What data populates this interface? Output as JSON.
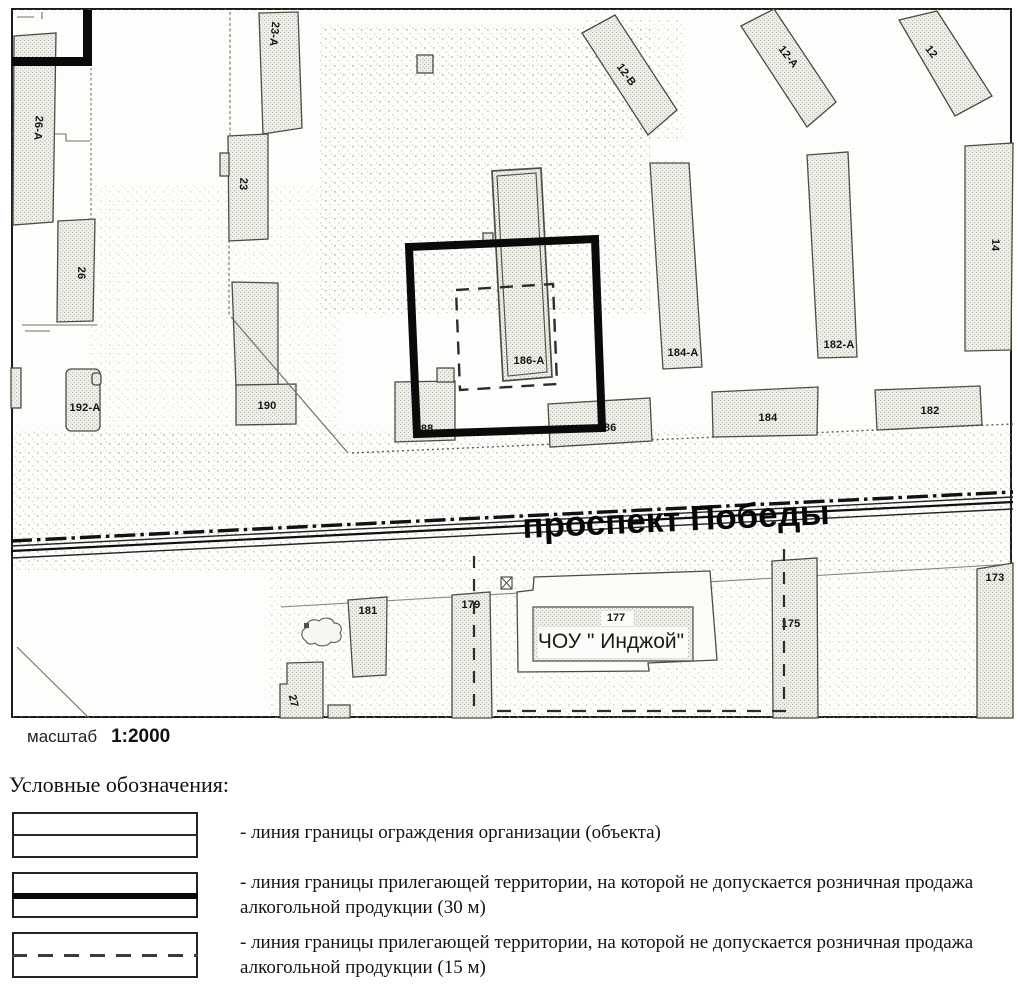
{
  "map": {
    "street": "проспект Победы",
    "scale_label": "масштаб",
    "scale_value": "1:2000",
    "buildings": [
      {
        "label": "26-А"
      },
      {
        "label": "26"
      },
      {
        "label": "23-А"
      },
      {
        "label": "23"
      },
      {
        "label": "192-А"
      },
      {
        "label": "190"
      },
      {
        "label": "188"
      },
      {
        "label": "186"
      },
      {
        "label": "186-А"
      },
      {
        "label": "184-А"
      },
      {
        "label": "182-А"
      },
      {
        "label": "184"
      },
      {
        "label": "182"
      },
      {
        "label": "12-В"
      },
      {
        "label": "12-А"
      },
      {
        "label": "12"
      },
      {
        "label": "14"
      },
      {
        "label": "181"
      },
      {
        "label": "179"
      },
      {
        "label": "177"
      },
      {
        "label": "ЧОУ \" Инджой\""
      },
      {
        "label": "175"
      },
      {
        "label": "173"
      },
      {
        "label": "27"
      }
    ],
    "icons": {
      "crossed_square": "utility-marker",
      "vegetation_blob": "tree-canopy"
    }
  },
  "legend": {
    "heading": "Условные обозначения:",
    "items": [
      {
        "text": "- линия границы ограждения организации (объекта)",
        "line_style": "solid-thin"
      },
      {
        "text": "- линия границы прилегающей территории, на которой не допускается розничная продажа алкогольной продукции (30 м)",
        "line_style": "solid-thick"
      },
      {
        "text": "- линия границы прилегающей территории, на которой не допускается розничная продажа алкогольной продукции (15 м)",
        "line_style": "dashed"
      }
    ]
  },
  "colors": {
    "boundary_30m": "#0a0a0a",
    "boundary_15m": "#2c2c2c",
    "building_fill": "#edeee8",
    "building_stroke": "#4a4d44",
    "speckle_green": "#9fbe93",
    "ink": "#141412"
  }
}
